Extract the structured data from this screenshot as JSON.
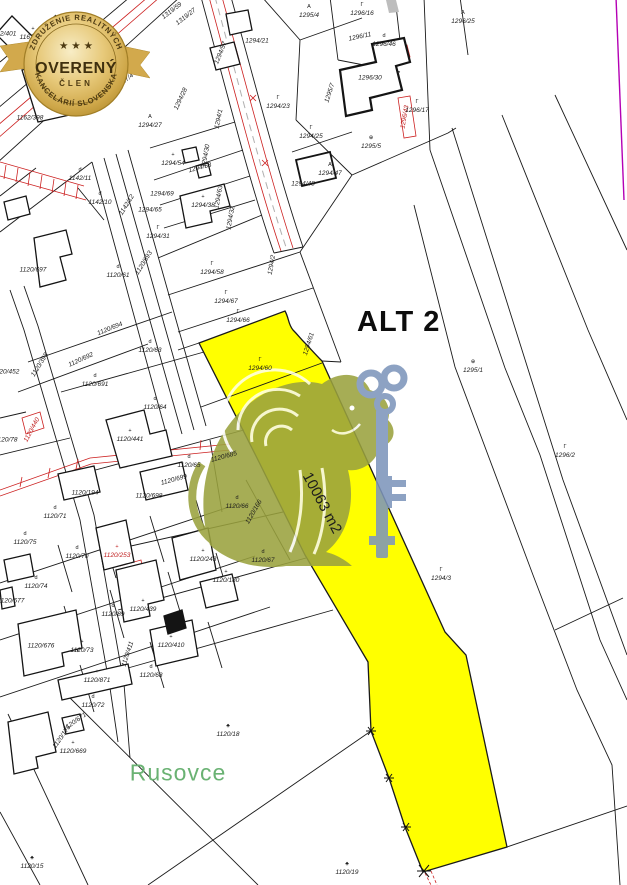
{
  "map": {
    "highlight_label": "ALT 2",
    "area_label": "10063 m2",
    "place_label": "Rusovce",
    "colors": {
      "highlight_parcel": "#ffff00",
      "place_text_green": "#6ab273",
      "boundary_black": "#1a1a1a",
      "utility_red": "#cc2020",
      "sheet_edge_magenta": "#b400b4",
      "watermark_blue": "#7e96bb",
      "watermark_olive": "#9aa23e"
    },
    "parcel_labels": [
      {
        "t": "1162/400",
        "x": 33,
        "y": 34,
        "s": "+"
      },
      {
        "t": "1162/401",
        "x": 3,
        "y": 34
      },
      {
        "t": "1162/397",
        "x": 55,
        "y": 89
      },
      {
        "t": "1162/398",
        "x": 30,
        "y": 118
      },
      {
        "t": "1317/4",
        "x": 125,
        "y": 81,
        "r": -38
      },
      {
        "t": "1319/59",
        "x": 172,
        "y": 11,
        "r": -38
      },
      {
        "t": "1319/27",
        "x": 186,
        "y": 17,
        "r": -38
      },
      {
        "t": "1294/27",
        "x": 150,
        "y": 122,
        "s": "A"
      },
      {
        "t": "1294/28",
        "x": 181,
        "y": 99,
        "r": -65
      },
      {
        "t": "1294/1",
        "x": 219,
        "y": 119,
        "r": -78
      },
      {
        "t": "1294/21",
        "x": 257,
        "y": 41
      },
      {
        "t": "1294/57",
        "x": 221,
        "y": 53,
        "r": -68
      },
      {
        "t": "1294/23",
        "x": 278,
        "y": 103,
        "s": "Γ"
      },
      {
        "t": "1295/4",
        "x": 309,
        "y": 12,
        "s": "A"
      },
      {
        "t": "1296/16",
        "x": 362,
        "y": 10,
        "s": "Γ"
      },
      {
        "t": "1296/11",
        "x": 360,
        "y": 37,
        "r": -12
      },
      {
        "t": "1296/46",
        "x": 384,
        "y": 41,
        "s": "d"
      },
      {
        "t": "1296/30",
        "x": 370,
        "y": 78
      },
      {
        "t": "1295/7",
        "x": 330,
        "y": 93,
        "r": -72
      },
      {
        "t": "1296/43",
        "x": 405,
        "y": 117,
        "r": -80,
        "c": "red"
      },
      {
        "t": "1296/17",
        "x": 417,
        "y": 107,
        "s": "Γ"
      },
      {
        "t": "1296/25",
        "x": 463,
        "y": 18,
        "s": "A"
      },
      {
        "t": "1294/25",
        "x": 311,
        "y": 133,
        "s": "Γ"
      },
      {
        "t": "1295/5",
        "x": 371,
        "y": 143,
        "s": "⊕"
      },
      {
        "t": "1294/47",
        "x": 330,
        "y": 170,
        "s": "A"
      },
      {
        "t": "1294/48",
        "x": 303,
        "y": 184
      },
      {
        "t": "1294/54",
        "x": 173,
        "y": 160,
        "s": "+"
      },
      {
        "t": "1294/53",
        "x": 200,
        "y": 168,
        "r": -15
      },
      {
        "t": "1294/69",
        "x": 162,
        "y": 194
      },
      {
        "t": "1294/65",
        "x": 150,
        "y": 210
      },
      {
        "t": "1294/38",
        "x": 203,
        "y": 202,
        "s": "+"
      },
      {
        "t": "1294/30",
        "x": 206,
        "y": 156,
        "r": -80
      },
      {
        "t": "1294/63",
        "x": 219,
        "y": 197,
        "r": -80
      },
      {
        "t": "1294/32",
        "x": 231,
        "y": 218,
        "r": -80
      },
      {
        "t": "1294/31",
        "x": 158,
        "y": 233,
        "s": "Γ"
      },
      {
        "t": "1294/2",
        "x": 272,
        "y": 265,
        "r": -80
      },
      {
        "t": "1294/58",
        "x": 212,
        "y": 269,
        "s": "Γ"
      },
      {
        "t": "1294/67",
        "x": 226,
        "y": 298,
        "s": "Γ"
      },
      {
        "t": "1294/66",
        "x": 238,
        "y": 317,
        "s": "Γ"
      },
      {
        "t": "1294/60",
        "x": 260,
        "y": 365,
        "s": "Γ"
      },
      {
        "t": "1294/61",
        "x": 309,
        "y": 344,
        "r": -72
      },
      {
        "t": "1142/11",
        "x": 80,
        "y": 175,
        "s": "d"
      },
      {
        "t": "1142/10",
        "x": 100,
        "y": 199,
        "s": "d"
      },
      {
        "t": "1142/12",
        "x": 127,
        "y": 205,
        "r": -58
      },
      {
        "t": "1120/693",
        "x": 144,
        "y": 263,
        "r": -58
      },
      {
        "t": "1120/697",
        "x": 33,
        "y": 270
      },
      {
        "t": "1120/61",
        "x": 118,
        "y": 272,
        "s": "d"
      },
      {
        "t": "1120/694",
        "x": 110,
        "y": 329,
        "r": -22
      },
      {
        "t": "1120/692",
        "x": 81,
        "y": 360,
        "r": -25
      },
      {
        "t": "1120/398",
        "x": 40,
        "y": 365,
        "r": -58
      },
      {
        "t": "1120/63",
        "x": 150,
        "y": 347,
        "s": "d"
      },
      {
        "t": "1120/691",
        "x": 95,
        "y": 381,
        "s": "d"
      },
      {
        "t": "1120/452",
        "x": 6,
        "y": 372
      },
      {
        "t": "1120/64",
        "x": 155,
        "y": 404,
        "s": "d"
      },
      {
        "t": "1120/441",
        "x": 130,
        "y": 436,
        "s": "+"
      },
      {
        "t": "1120/440",
        "x": 32,
        "y": 430,
        "r": -62,
        "c": "red"
      },
      {
        "t": "1120/78",
        "x": 6,
        "y": 440
      },
      {
        "t": "1120/65",
        "x": 189,
        "y": 462,
        "s": "d"
      },
      {
        "t": "1120/685",
        "x": 224,
        "y": 457,
        "r": -15
      },
      {
        "t": "1120/699",
        "x": 174,
        "y": 480,
        "r": -15
      },
      {
        "t": "1120/698",
        "x": 149,
        "y": 496
      },
      {
        "t": "1120/194",
        "x": 85,
        "y": 493
      },
      {
        "t": "1120/71",
        "x": 55,
        "y": 513,
        "s": "d"
      },
      {
        "t": "1120/66",
        "x": 237,
        "y": 503,
        "s": "d"
      },
      {
        "t": "1120/166",
        "x": 254,
        "y": 512,
        "r": -60
      },
      {
        "t": "1120/75",
        "x": 25,
        "y": 539,
        "s": "d"
      },
      {
        "t": "1120/70",
        "x": 77,
        "y": 553,
        "s": "d"
      },
      {
        "t": "1120/253",
        "x": 117,
        "y": 552,
        "c": "red",
        "s": "+"
      },
      {
        "t": "1120/243",
        "x": 203,
        "y": 556,
        "s": "+"
      },
      {
        "t": "1120/67",
        "x": 263,
        "y": 557,
        "s": "d"
      },
      {
        "t": "1120/180",
        "x": 226,
        "y": 577,
        "s": "+"
      },
      {
        "t": "1120/74",
        "x": 36,
        "y": 583,
        "s": "d"
      },
      {
        "t": "1120/677",
        "x": 11,
        "y": 601
      },
      {
        "t": "1120/89",
        "x": 113,
        "y": 611,
        "s": "d"
      },
      {
        "t": "1120/439",
        "x": 143,
        "y": 606,
        "s": "+"
      },
      {
        "t": "1120/676",
        "x": 41,
        "y": 646
      },
      {
        "t": "1120/73",
        "x": 82,
        "y": 647,
        "s": "+"
      },
      {
        "t": "1120/410",
        "x": 171,
        "y": 642,
        "s": "+"
      },
      {
        "t": "1120/411",
        "x": 128,
        "y": 654,
        "r": -72
      },
      {
        "t": "1120/68",
        "x": 151,
        "y": 672,
        "s": "d"
      },
      {
        "t": "1120/871",
        "x": 97,
        "y": 677,
        "s": "+"
      },
      {
        "t": "1120/72",
        "x": 93,
        "y": 702,
        "s": "d"
      },
      {
        "t": "1120/671",
        "x": 75,
        "y": 722,
        "r": -35
      },
      {
        "t": "1120/669",
        "x": 73,
        "y": 748,
        "s": "+"
      },
      {
        "t": "1120/175",
        "x": 62,
        "y": 737,
        "r": -55
      },
      {
        "t": "1120/18",
        "x": 228,
        "y": 731,
        "s": "♣"
      },
      {
        "t": "1120/15",
        "x": 32,
        "y": 863,
        "s": "♣"
      },
      {
        "t": "1120/19",
        "x": 347,
        "y": 869,
        "s": "♣"
      },
      {
        "t": "1294/3",
        "x": 441,
        "y": 575,
        "s": "Γ"
      },
      {
        "t": "1295/1",
        "x": 473,
        "y": 367,
        "s": "⊕"
      },
      {
        "t": "1296/2",
        "x": 565,
        "y": 452,
        "s": "Γ"
      }
    ]
  },
  "badge": {
    "arc_top": "ZDRUŽENIE REALITNÝCH",
    "stars": "★ ★ ★",
    "title": "OVERENÝ",
    "subtitle": "ČLEN",
    "arc_bottom": "KANCELÁRIÍ SLOVENSKA",
    "gold": "#c9a235"
  },
  "icons": {
    "watermark": "lion-with-key-watermark",
    "badge": "gold-seal-with-ribbon",
    "survey_marks": "asterisk-boundary-points"
  }
}
